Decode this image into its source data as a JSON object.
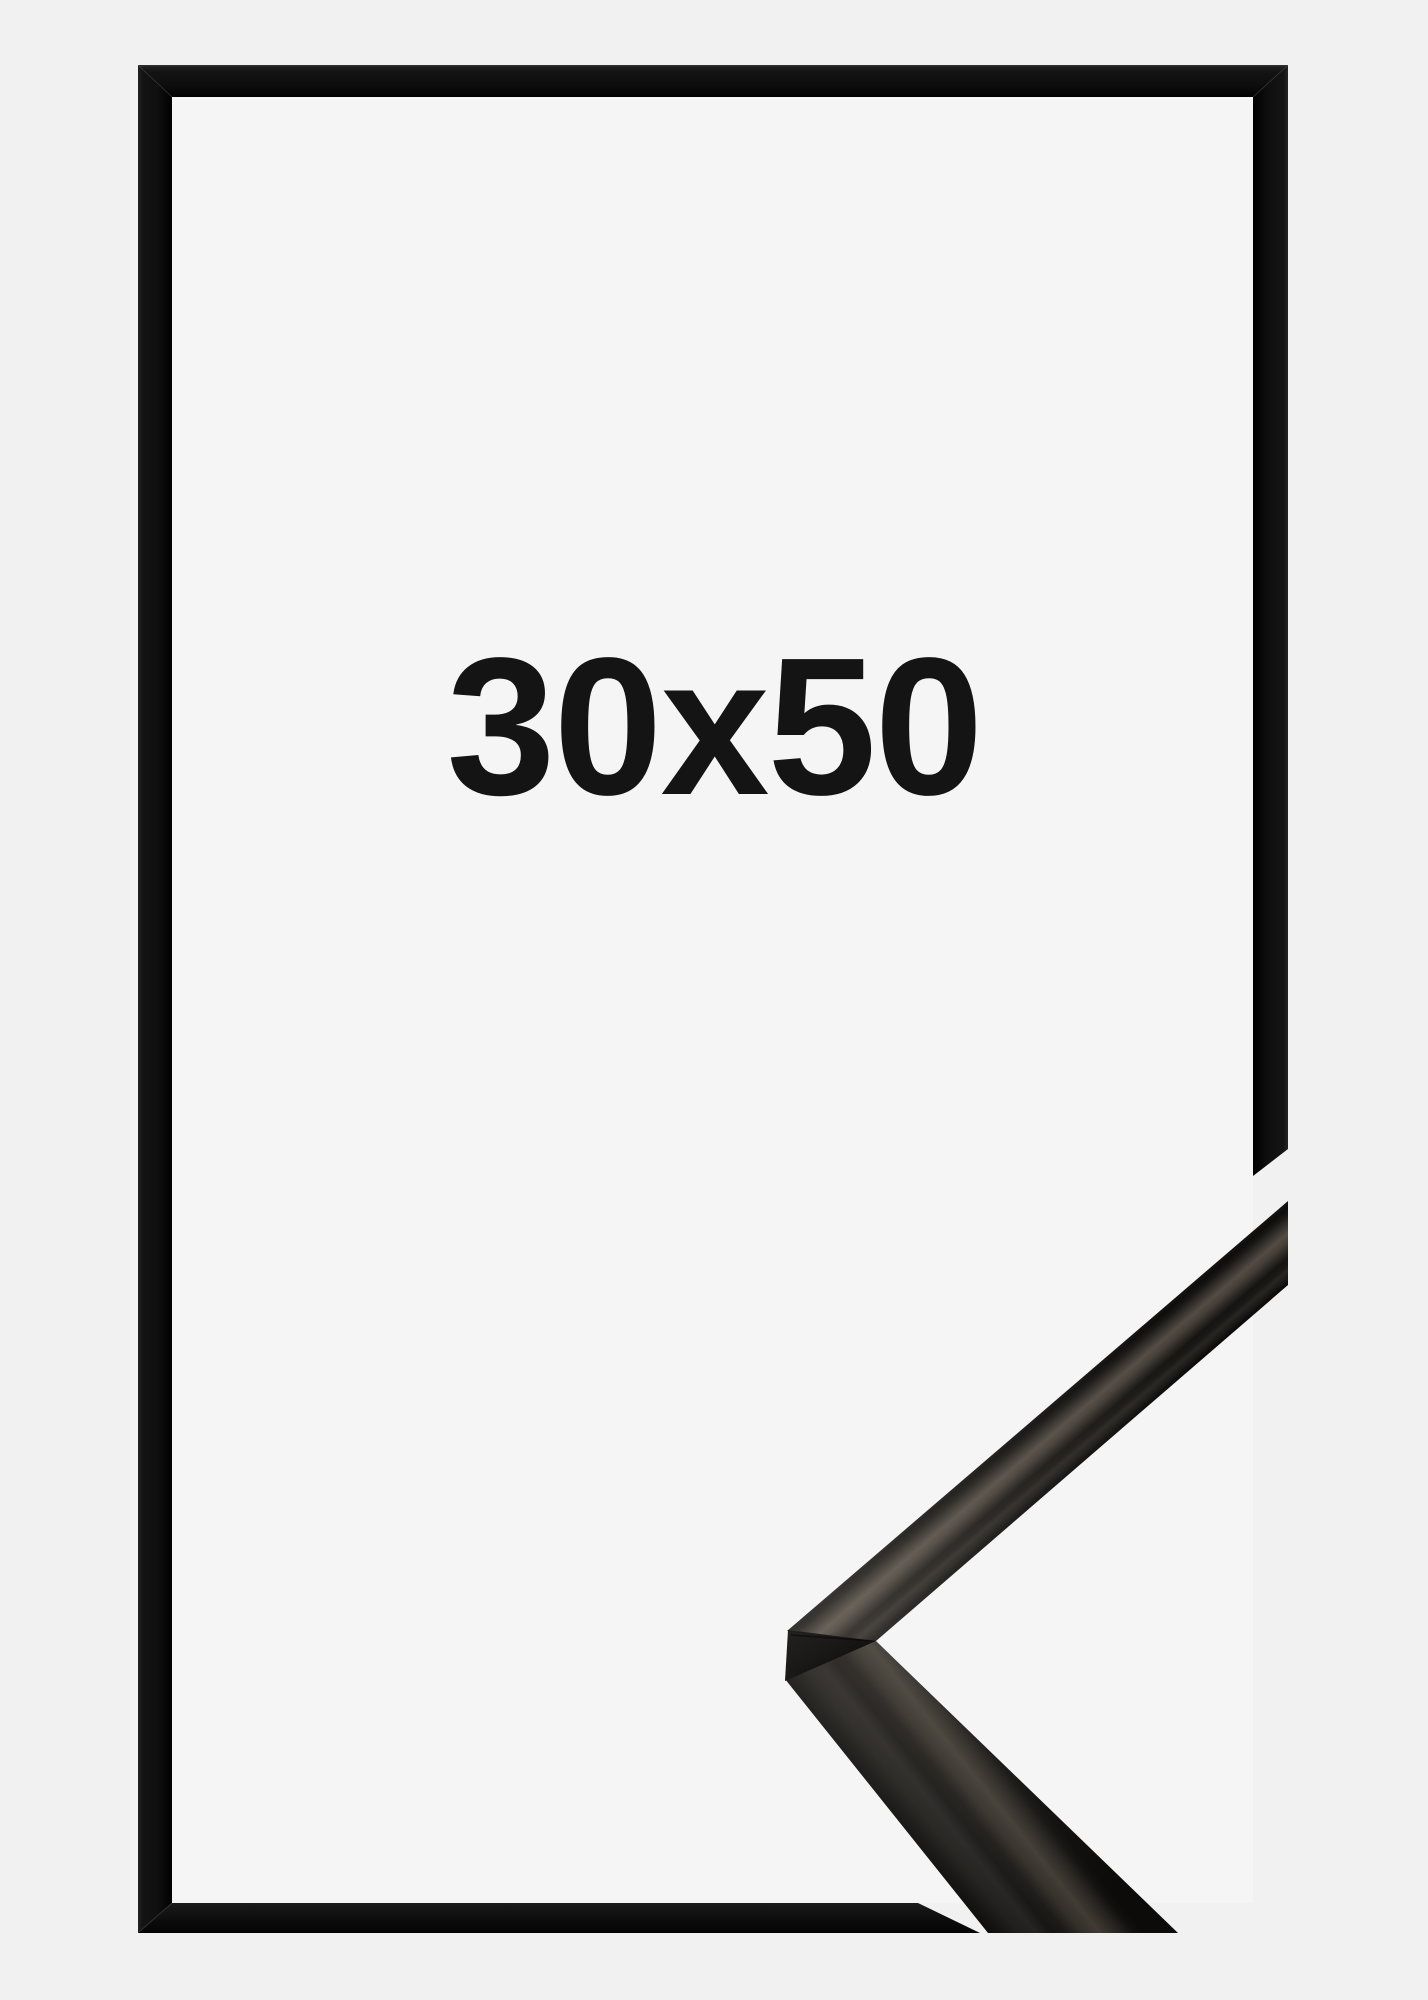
{
  "frame_product": {
    "size_label": "30x50",
    "colors": {
      "background": "#f1f1f2",
      "backing": "#f5f5f6",
      "frame_black": "#101010",
      "metal_face_highlight": "#524c44",
      "label_text": "#141414"
    }
  }
}
